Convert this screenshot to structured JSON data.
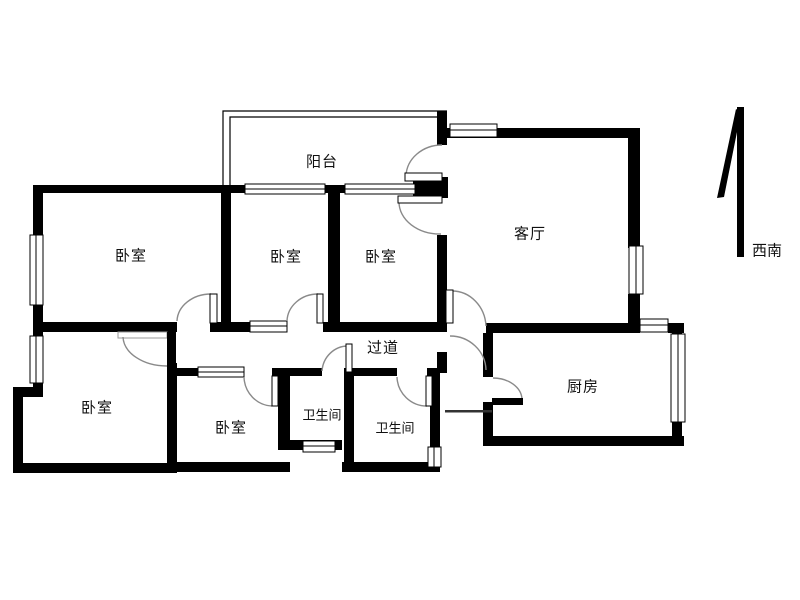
{
  "floorplan": {
    "rooms": [
      {
        "id": "balcony",
        "label": "阳台"
      },
      {
        "id": "living-room",
        "label": "客厅"
      },
      {
        "id": "bedroom-top-left",
        "label": "卧室"
      },
      {
        "id": "bedroom-top-middle",
        "label": "卧室"
      },
      {
        "id": "bedroom-top-right",
        "label": "卧室"
      },
      {
        "id": "hallway",
        "label": "过道"
      },
      {
        "id": "bedroom-bottom-left",
        "label": "卧室"
      },
      {
        "id": "bedroom-bottom-middle",
        "label": "卧室"
      },
      {
        "id": "bathroom-left",
        "label": "卫生间"
      },
      {
        "id": "bathroom-right",
        "label": "卫生间"
      },
      {
        "id": "kitchen",
        "label": "厨房"
      }
    ],
    "compass": {
      "direction_label": "西南"
    },
    "colors": {
      "wall": "#000000",
      "background": "#ffffff",
      "door_arc": "#8a8a8a",
      "text": "#111111"
    }
  }
}
